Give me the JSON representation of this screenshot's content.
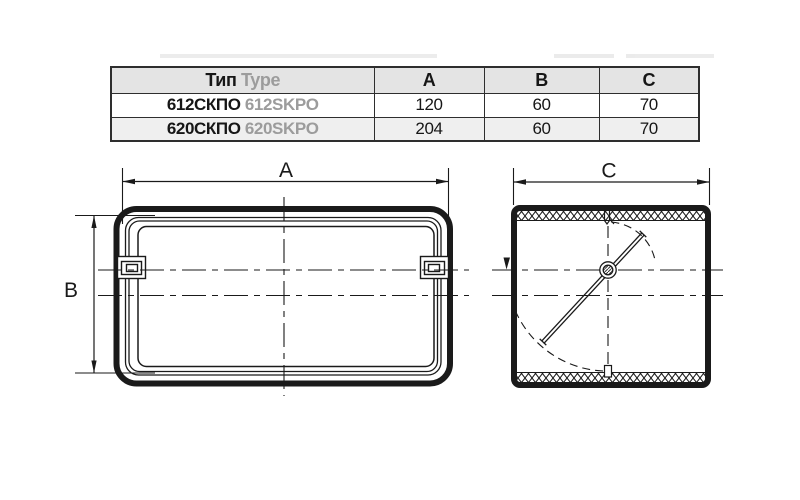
{
  "table": {
    "header": {
      "type_ru": "Тип",
      "type_en": "Type",
      "col_a": "A",
      "col_b": "B",
      "col_c": "C"
    },
    "rows": [
      {
        "type_ru": "612СКПО",
        "type_en": "612SKPO",
        "a": "120",
        "b": "60",
        "c": "70"
      },
      {
        "type_ru": "620СКПО",
        "type_en": "620SKPO",
        "a": "204",
        "b": "60",
        "c": "70"
      }
    ]
  },
  "drawing": {
    "dim_a_label": "A",
    "dim_b_label": "B",
    "dim_c_label": "C",
    "line_color": "#1a1a1a"
  }
}
